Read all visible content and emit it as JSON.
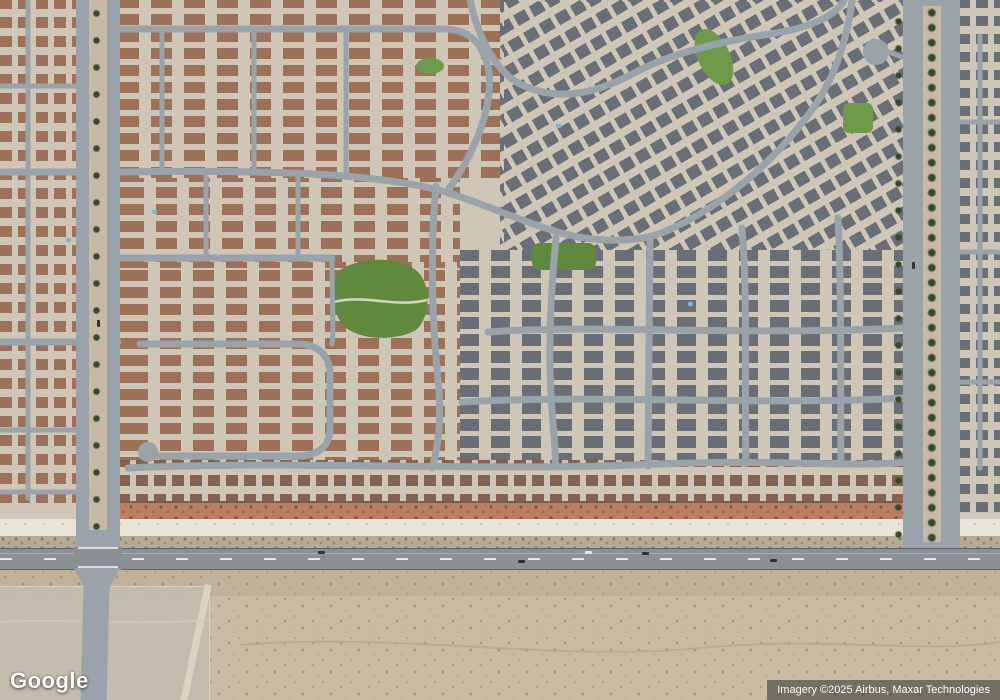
{
  "map": {
    "provider_logo": "Google",
    "attribution": "Imagery ©2025 Airbus, Maxar Technologies",
    "view": "satellite"
  },
  "palette": {
    "residential_ground": "#cfc6b7",
    "roof_brown": "#9a6e55",
    "roof_brown_dark": "#83604b",
    "roof_gray": "#666c75",
    "street": "#9aa2aa",
    "major_road": "#8b9096",
    "median_tan": "#c6baa7",
    "park": "#5f8a3e",
    "park_light": "#6f9a4b",
    "desert": "#c9bba4",
    "landscape_red": "#b97f63",
    "strip_white": "#eae4d9",
    "scrub": "#b5ab97",
    "tree": "#35482a",
    "wall": "#6a6157",
    "pool": "#7fb6c9",
    "car_dark": "#2e3238"
  }
}
